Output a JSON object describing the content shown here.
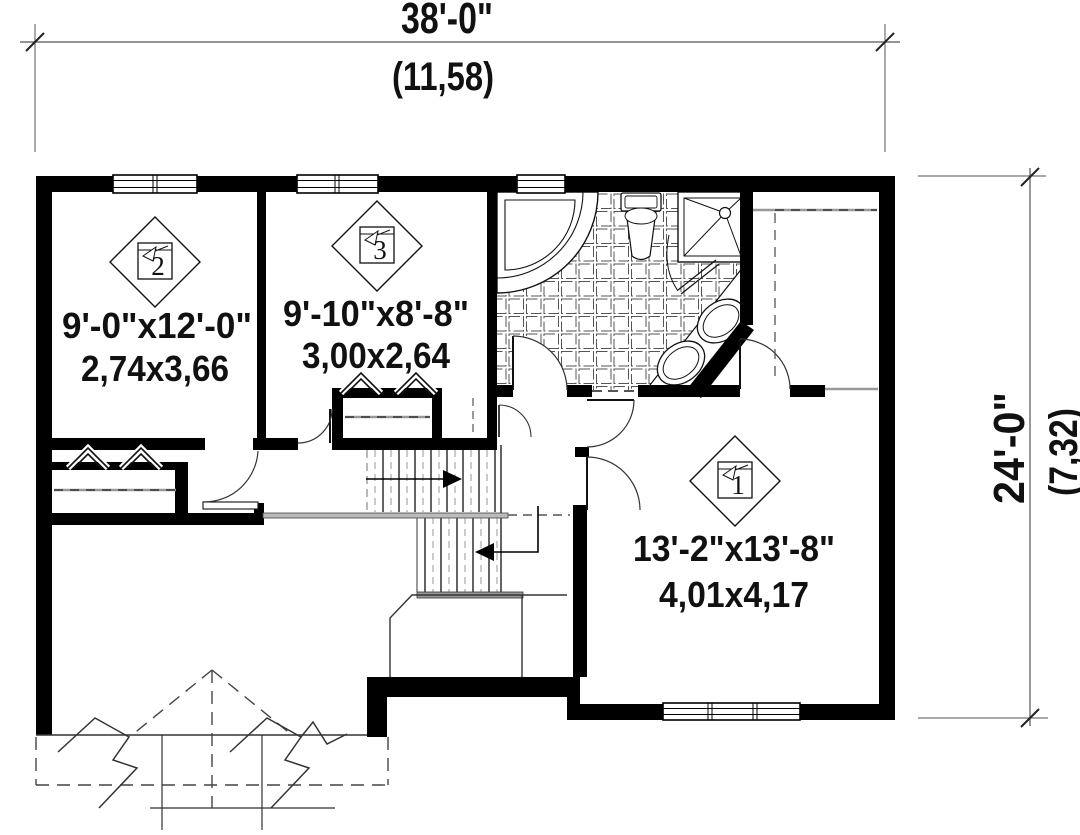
{
  "dimensions": {
    "width": {
      "imperial": "38'-0\"",
      "metric": "(11,58)"
    },
    "height": {
      "imperial": "24'-0\"",
      "metric": "(7,32)"
    }
  },
  "rooms": [
    {
      "number": "2",
      "imperial": "9'-0\"x12'-0\"",
      "metric": "2,74x3,66"
    },
    {
      "number": "3",
      "imperial": "9'-10\"x8'-8\"",
      "metric": "3,00x2,64"
    },
    {
      "number": "1",
      "imperial": "13'-2\"x13'-8\"",
      "metric": "4,01x4,17"
    }
  ],
  "colors": {
    "walls": "#000000",
    "lines": "#333333",
    "gray": "#999999",
    "background": "#ffffff"
  }
}
